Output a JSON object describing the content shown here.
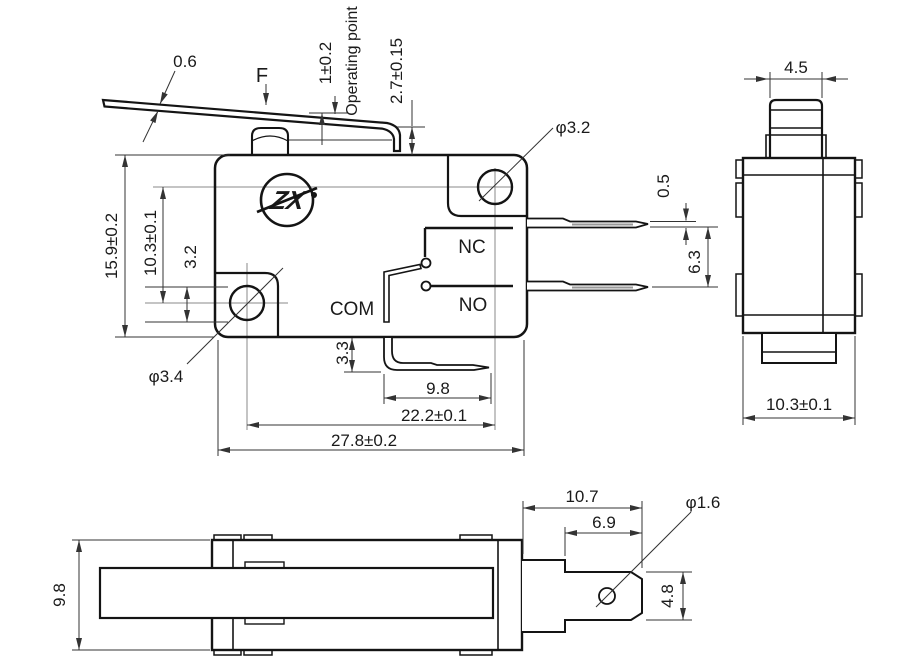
{
  "drawing": {
    "title_hint": "micro switch technical drawing",
    "front_view": {
      "lever_thickness": "0.6",
      "force": "F",
      "pretravel": "1±0.2",
      "operating_point": "Operating point",
      "free_position": "2.7±0.15",
      "top_hole_dia": "φ3.2",
      "body_height": "15.9±0.2",
      "hole_vspacing": "10.3±0.1",
      "hole_offset": "3.2",
      "bottom_hole_dia": "φ3.4",
      "nc": "NC",
      "no": "NO",
      "com": "COM",
      "terminal_drop": "3.3",
      "com_terminal_length": "9.8",
      "hole_hspacing": "22.2±0.1",
      "body_width": "27.8±0.2",
      "terminal_thickness": "0.5",
      "terminal_spacing": "6.3"
    },
    "side_view": {
      "button_width": "4.5",
      "body_depth": "10.3±0.1"
    },
    "bottom_view": {
      "body_thickness": "9.8",
      "terminal_length": "10.7",
      "blade_length": "6.9",
      "hole_dia": "φ1.6",
      "blade_width": "4.8"
    },
    "logo_text": "ZX",
    "colors": {
      "object_line": "#141414",
      "dimension_line": "#333333",
      "background": "#ffffff"
    }
  }
}
